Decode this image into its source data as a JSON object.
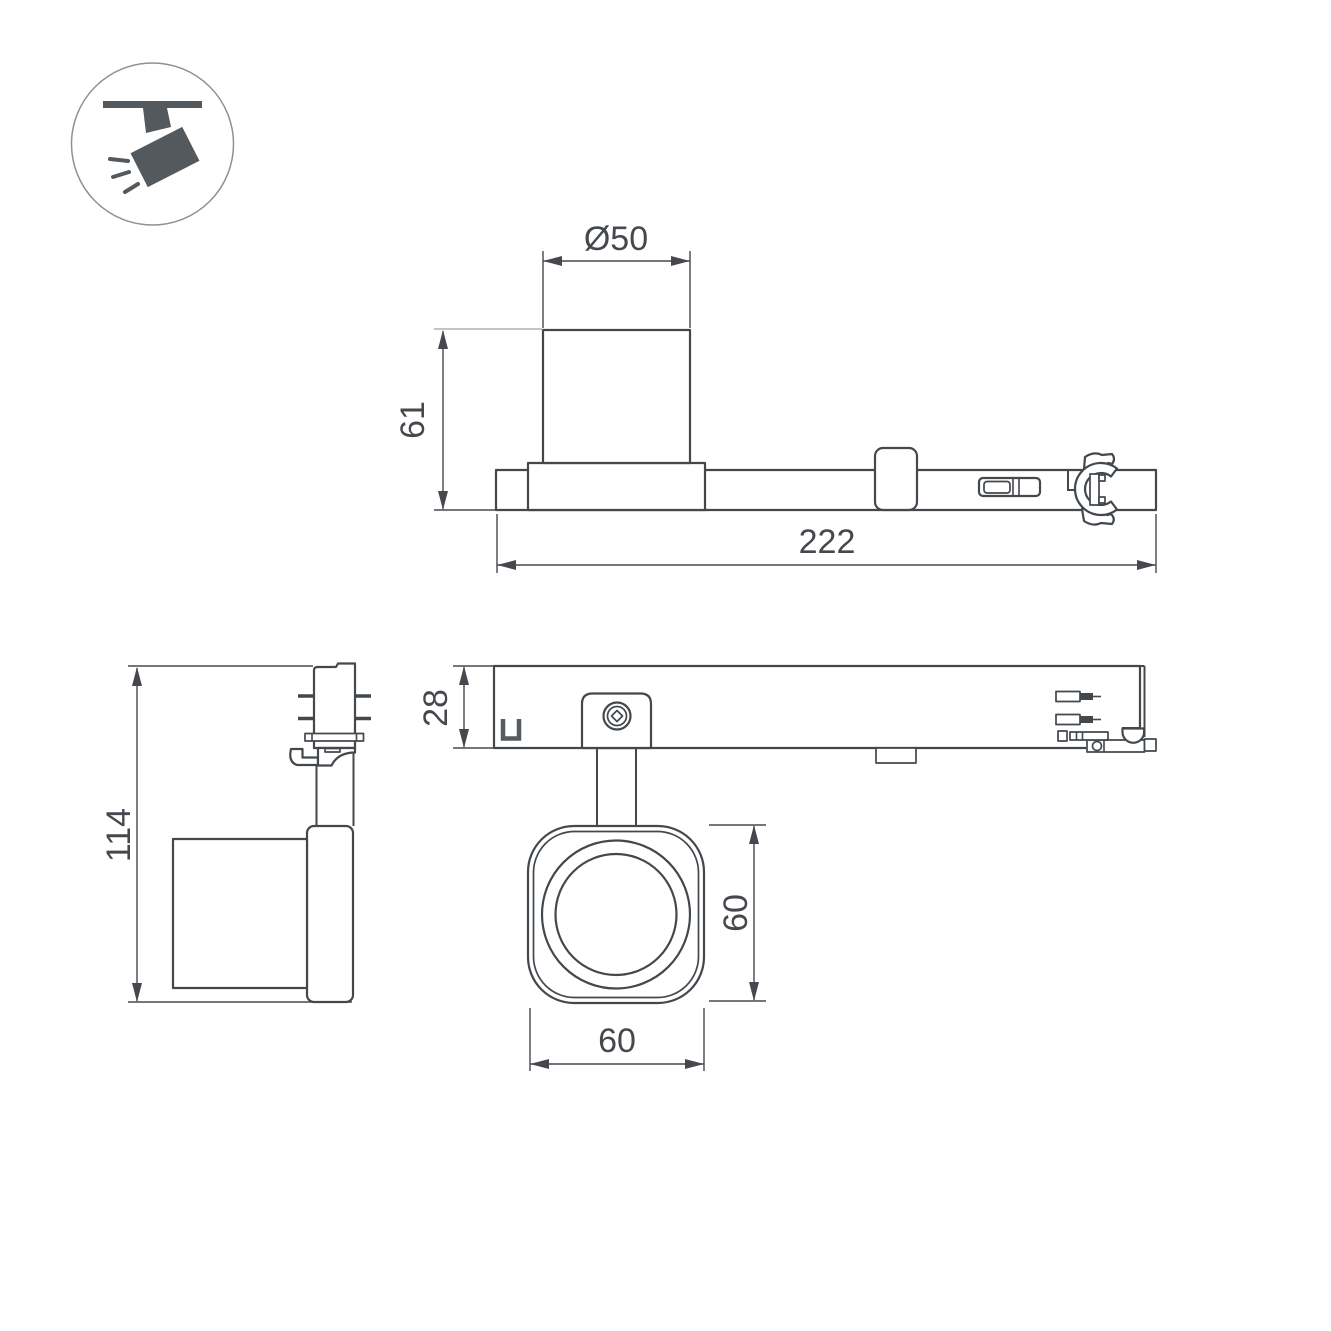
{
  "colors": {
    "background": "#ffffff",
    "line": "#43484d",
    "dim": "#45494e",
    "light_line": "#adb0b3",
    "icon": "#54595e"
  },
  "legend": {
    "icon": "ceiling-track-spotlight-icon"
  },
  "dimensions": {
    "diameter": "Ø50",
    "body_height": "61",
    "total_length": "222",
    "fixture_height": "114",
    "track_height": "28",
    "head_height": "60",
    "head_width": "60"
  }
}
